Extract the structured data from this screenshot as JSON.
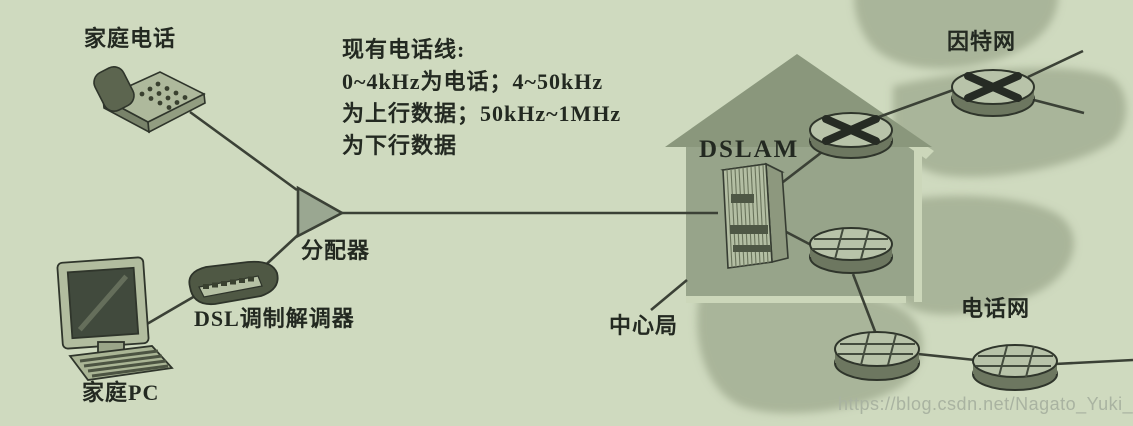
{
  "figure": {
    "description_note": {
      "line1": "现有电话线:",
      "line2": "0~4kHz为电话；4~50kHz",
      "line3": "为上行数据；50kHz~1MHz",
      "line4": "为下行数据"
    },
    "labels": {
      "home_phone": "家庭电话",
      "home_pc": "家庭PC",
      "dsl_modem": "DSL调制解调器",
      "splitter": "分配器",
      "dslam": "DSLAM",
      "central_office": "中心局",
      "internet": "因特网",
      "telephone_network": "电话网"
    },
    "watermark": "https://blog.csdn.net/Nagato_Yuki_SOS",
    "connections": [
      "家庭电话 - 分配器",
      "家庭PC - DSL调制解调器",
      "DSL调制解调器 - 分配器",
      "分配器 - DSLAM (现有电话线)",
      "DSLAM - 路由器 - 因特网",
      "DSLAM - 交换机 - 电话网"
    ],
    "colors": {
      "background": "#cfdabf",
      "blob": "#a2ae93",
      "house_roof": "#8a977c",
      "house_body": "#97a48a",
      "light_edge": "#ccd7ba",
      "line": "#3b4136",
      "text": "#232921",
      "watermark_text": "#a9b3a1"
    }
  }
}
